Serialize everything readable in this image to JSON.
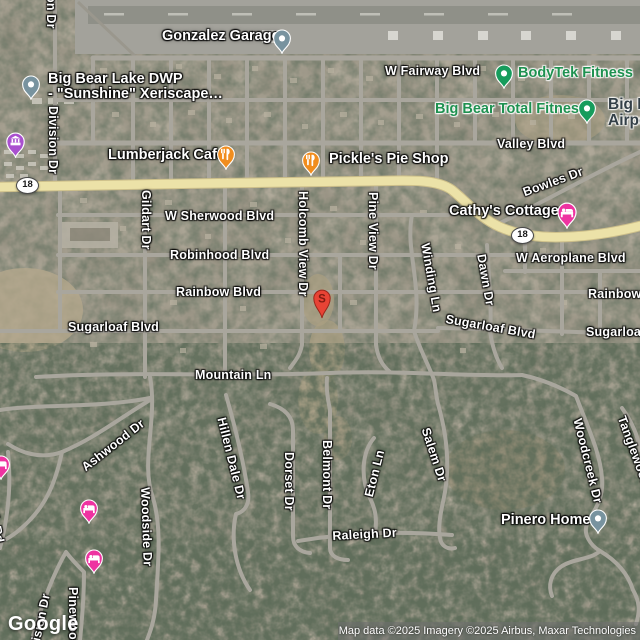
{
  "map": {
    "logo": "Google",
    "attribution": "Map data ©2025 Imagery ©2025 Airbus, Maxar Technologies",
    "highway_shield": "18"
  },
  "marker": {
    "letter": "S"
  },
  "colors": {
    "restaurant_orange": "#F18D1E",
    "fitness_green": "#169C5C",
    "lodging_pink": "#EE33A1",
    "poi_gray": "#78939F",
    "attraction_purple": "#A950CF",
    "marker_red": "#E84335",
    "highway_yellow": "#ECE2A8",
    "green_label": "#1E9150"
  },
  "icons": {
    "restaurant": "fork-knife-icon",
    "lodging": "bed-icon",
    "fitness": "dot-icon",
    "generic_poi": "dot-icon",
    "attraction": "building-icon",
    "marker": "teardrop-letter-marker"
  },
  "roads": {
    "division_top_fragment": "on Dr",
    "division": "Division Dr",
    "w_fairway": "W Fairway Blvd",
    "valley": "Valley Blvd",
    "bowles": "Bowles Dr",
    "w_sherwood": "W Sherwood Blvd",
    "gildart": "Gildart Dr",
    "holcomb_view": "Holcomb View Dr",
    "pine_view": "Pine View Dr",
    "robinhood": "Robinhood Blvd",
    "winding": "Winding Ln",
    "dawn": "Dawn Dr",
    "w_aeroplane": "W Aeroplane Blvd",
    "rainbow_left": "Rainbow Blvd",
    "rainbow_right": "Rainbow Blvd",
    "sugarloaf_left": "Sugarloaf Blvd",
    "sugarloaf_mid": "Sugarloaf Blvd",
    "sugarloaf_right": "Sugarloaf Blvd",
    "mountain": "Mountain Ln",
    "ashwood": "Ashwood Dr",
    "hillen_dale": "Hillen Dale Dr",
    "dorset": "Dorset Dr",
    "belmont": "Belmont Dr",
    "eton": "Eton Ln",
    "salem": "Salem Dr",
    "woodcreek": "Woodcreek Dr",
    "tanglewood": "Tanglewood Dr",
    "raleigh": "Raleigh Dr",
    "woodside": "Woodside Dr",
    "pinewood": "Pinewood Dr",
    "division_bottom": "Division Dr",
    "k_rd_fragment": "k Rd"
  },
  "pois": {
    "gonzalez_garage": "Gonzalez Garage",
    "dwp_line1": "Big Bear Lake DWP",
    "dwp_line2": "- \"Sunshine\" Xeriscape…",
    "bodytek": "BodyTek Fitness",
    "big_bear_total_fitness": "Big Bear Total Fitness",
    "airport_line1": "Big Bear",
    "airport_line2": "Airport",
    "lumberjack": "Lumberjack Cafe",
    "pickles": "Pickle's Pie Shop",
    "cathys": "Cathy's Cottages",
    "pinero": "Pinero Home"
  }
}
